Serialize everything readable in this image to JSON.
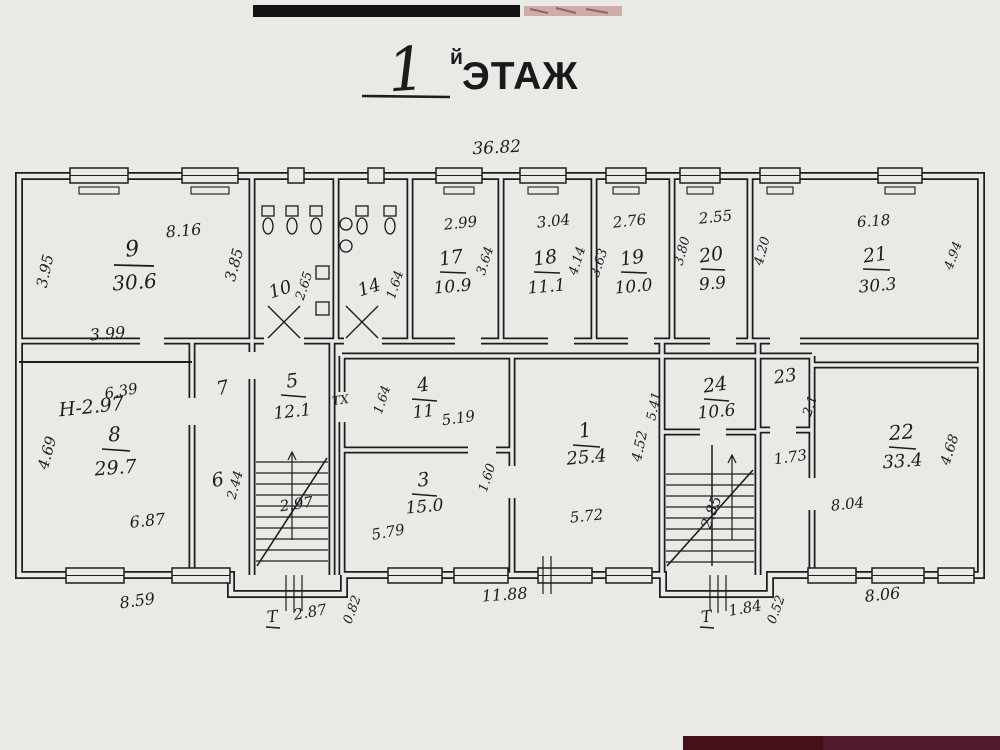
{
  "title": {
    "floor_number": "1",
    "floor_suffix": "й",
    "floor_word": "ЭТАЖ"
  },
  "building": {
    "top_width": "36.82"
  },
  "labels": {
    "entrance": "Т",
    "shaft": "ТХ"
  },
  "colors": {
    "ink": "#1d1d1d",
    "paper": "#e9e9e6",
    "redaction_bar": "#121212",
    "maroon_bar_left": "#451019",
    "maroon_bar_right": "#52182c"
  },
  "rooms": {
    "r9": {
      "number": "9",
      "area": "30.6",
      "top": "8.16",
      "left": "3.95",
      "right": "3.85",
      "bottom": "3.99"
    },
    "r10": {
      "number": "10",
      "side": "2.65"
    },
    "r14": {
      "number": "14",
      "side": "1.64"
    },
    "r17": {
      "number": "17",
      "area": "10.9",
      "top": "2.99",
      "right": "3.64"
    },
    "r18": {
      "number": "18",
      "area": "11.1",
      "top": "3.04",
      "right": "4.14"
    },
    "r19": {
      "number": "19",
      "area": "10.0",
      "top": "2.76",
      "left": "3.63"
    },
    "r20": {
      "number": "20",
      "area": "9.9",
      "top": "2.55",
      "left": "3.80"
    },
    "r21": {
      "number": "21",
      "area": "30.3",
      "top": "6.18",
      "left": "4.20",
      "right": "4.94"
    },
    "r8": {
      "number": "8",
      "area": "29.7",
      "height_note": "H-2.97",
      "top": "6.39",
      "left": "4.69",
      "bottom": "6.87"
    },
    "r7": {
      "number": "7"
    },
    "r6": {
      "number": "6",
      "side": "2.44"
    },
    "r5": {
      "number": "5",
      "area": "12.1",
      "stair_dim": "2.97"
    },
    "r4": {
      "number": "4",
      "area": "11",
      "left": "1.64",
      "bottom": "5.19"
    },
    "r3": {
      "number": "3",
      "area": "15.0",
      "bottom": "5.79",
      "right": "1.60"
    },
    "r1": {
      "number": "1",
      "area": "25.4",
      "right": "4.52",
      "bottom": "5.72"
    },
    "r24": {
      "number": "24",
      "area": "10.6",
      "left": "5.41"
    },
    "r23": {
      "number": "23",
      "right": "2.1",
      "bottom": "1.73"
    },
    "r22": {
      "number": "22",
      "area": "33.4",
      "right": "4.68",
      "bottom": "8.04"
    },
    "stair_right": {
      "dim": "2.85"
    }
  },
  "bottom_dims": {
    "left": "8.59",
    "porch_left_width": "2.87",
    "porch_left_depth": "0.82",
    "center": "11.88",
    "porch_right_width": "1.84",
    "porch_right_depth": "0.52",
    "right": "8.06"
  }
}
